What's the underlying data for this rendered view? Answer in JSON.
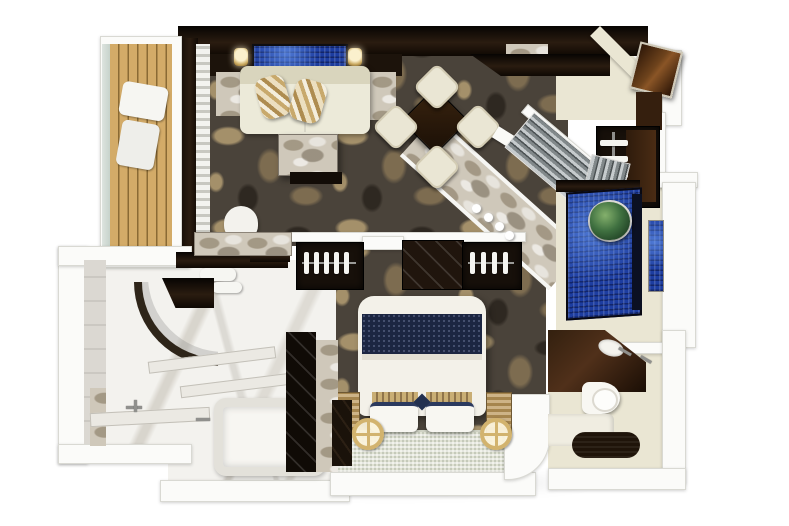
{
  "palette": {
    "wall": "#fbfbf9",
    "wall_edge": "#d9d9d3",
    "cream": "#eae6d3",
    "dark2": "#2a1c10",
    "carpet_base": "#4a433a",
    "carpet_motif_light": "#a4906a",
    "carpet_motif_mid": "#7d6c50",
    "carpet_motif_dark": "#2e2821",
    "deck": "#d3ab68",
    "deck_gap": "#8a6a34",
    "marble_light": "#f3f2ee",
    "marble_gray": "#cfc8ba",
    "mosaic": "#1d3da0",
    "navy": "#1c2642",
    "stripe_tan": "#c8a96c",
    "gold": "#d2b36e",
    "plant": "#3f7040",
    "door_wood": "#6e431c",
    "louver_gray": "#8b9294",
    "glass": "#c7d2cb"
  },
  "rooms": [
    {
      "name": "balcony"
    },
    {
      "name": "living-room"
    },
    {
      "name": "dining-area"
    },
    {
      "name": "entry-foyer"
    },
    {
      "name": "hall-closet"
    },
    {
      "name": "mosaic-shower-room"
    },
    {
      "name": "bedroom"
    },
    {
      "name": "master-bathroom"
    },
    {
      "name": "guest-bathroom"
    }
  ]
}
